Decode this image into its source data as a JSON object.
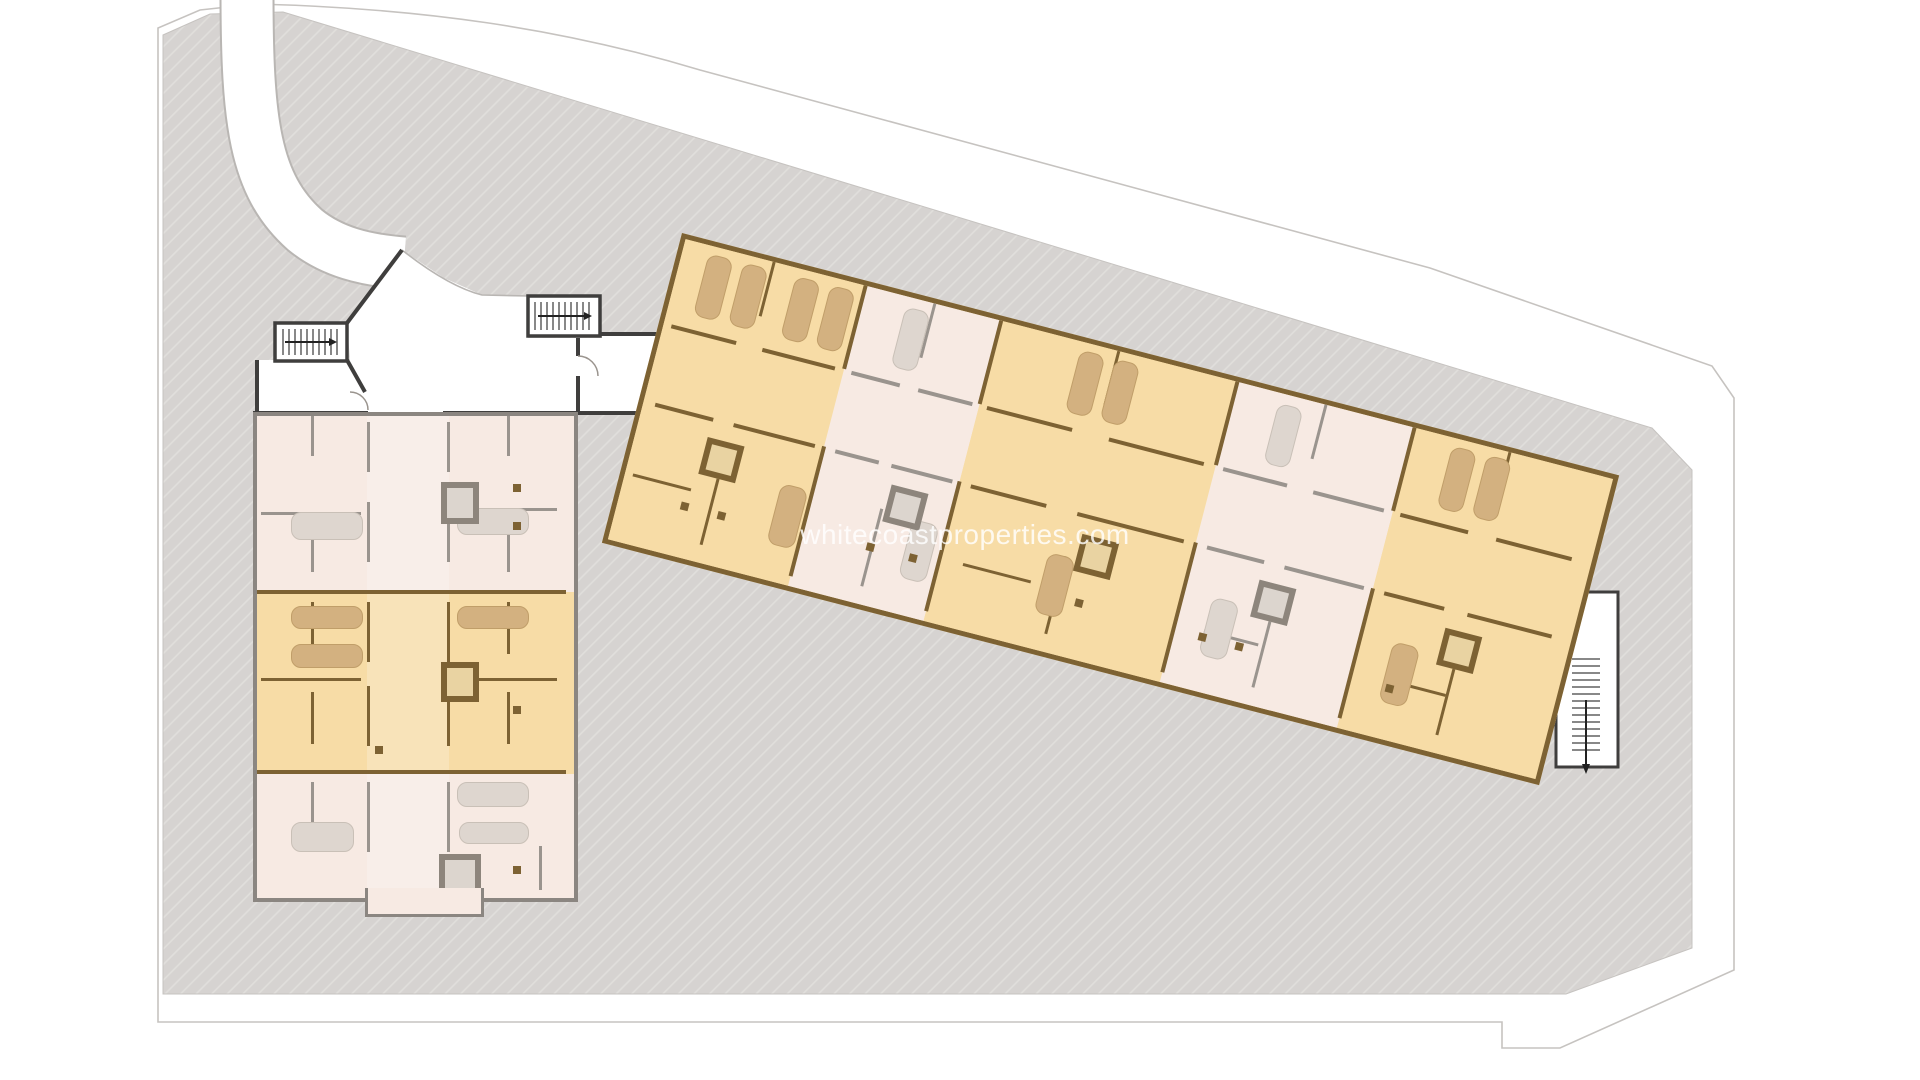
{
  "watermark": {
    "text": "whitecoastproperties.com"
  },
  "colors": {
    "page_bg": "#ffffff",
    "plot_fill": "#d6d3d1",
    "hatch_line": "#e1dfdc",
    "boundary_line": "#c6c3c0",
    "road_edge": "#b9b6b3",
    "black_wall": "#3f3e3d",
    "orange_fill": "#f7dca6",
    "orange_wall": "#7d6233",
    "orange_core_fill": "#e9d3a2",
    "tan_bed": "#d3b180",
    "tan_bed_border": "#c09e69",
    "pink_fill": "#f7eae3",
    "pink_wall": "#9a948e",
    "pink_bed": "#ded6cf",
    "pink_bed_border": "#c9c0b7",
    "pink_core_fill": "#dcd5ce",
    "gray_core_wall": "#8d857c",
    "left_wall": "#8b8681",
    "stair_tread": "#555555"
  },
  "angled_building": {
    "units": [
      {
        "x": 0,
        "w": 186,
        "color": "orange_fill",
        "wall": "orange_wall"
      },
      {
        "x": 186,
        "w": 140,
        "color": "pink_fill",
        "wall": "pink_wall"
      },
      {
        "x": 326,
        "w": 244,
        "color": "orange_fill",
        "wall": "orange_wall"
      },
      {
        "x": 570,
        "w": 183,
        "color": "pink_fill",
        "wall": "pink_wall"
      },
      {
        "x": 753,
        "w": 195,
        "color": "orange_fill",
        "wall": "orange_wall"
      }
    ],
    "walls": [
      {
        "x": 184,
        "y": 0,
        "w": 4,
        "h": 86,
        "c": "orange_wall"
      },
      {
        "x": 184,
        "y": 166,
        "w": 4,
        "h": 134,
        "c": "orange_wall"
      },
      {
        "x": 324,
        "y": 0,
        "w": 4,
        "h": 86,
        "c": "orange_wall"
      },
      {
        "x": 324,
        "y": 166,
        "w": 4,
        "h": 134,
        "c": "orange_wall"
      },
      {
        "x": 568,
        "y": 0,
        "w": 4,
        "h": 86,
        "c": "orange_wall"
      },
      {
        "x": 568,
        "y": 166,
        "w": 4,
        "h": 134,
        "c": "orange_wall"
      },
      {
        "x": 751,
        "y": 0,
        "w": 4,
        "h": 86,
        "c": "orange_wall"
      },
      {
        "x": 751,
        "y": 166,
        "w": 4,
        "h": 134,
        "c": "orange_wall"
      },
      {
        "x": 90,
        "y": 0,
        "w": 3,
        "h": 56,
        "c": "orange_wall"
      },
      {
        "x": 256,
        "y": 0,
        "w": 3,
        "h": 56,
        "c": "pink_wall"
      },
      {
        "x": 446,
        "y": 0,
        "w": 3,
        "h": 56,
        "c": "orange_wall"
      },
      {
        "x": 660,
        "y": 0,
        "w": 3,
        "h": 56,
        "c": "pink_wall"
      },
      {
        "x": 850,
        "y": 0,
        "w": 3,
        "h": 56,
        "c": "orange_wall"
      },
      {
        "x": 90,
        "y": 212,
        "w": 3,
        "h": 80,
        "c": "orange_wall"
      },
      {
        "x": 256,
        "y": 212,
        "w": 3,
        "h": 80,
        "c": "pink_wall"
      },
      {
        "x": 446,
        "y": 212,
        "w": 3,
        "h": 80,
        "c": "orange_wall"
      },
      {
        "x": 660,
        "y": 212,
        "w": 3,
        "h": 80,
        "c": "pink_wall"
      },
      {
        "x": 850,
        "y": 212,
        "w": 3,
        "h": 80,
        "c": "orange_wall"
      },
      {
        "x": 8,
        "y": 240,
        "w": 60,
        "h": 3,
        "c": "orange_wall"
      },
      {
        "x": 350,
        "y": 244,
        "w": 70,
        "h": 3,
        "c": "orange_wall"
      },
      {
        "x": 600,
        "y": 248,
        "w": 56,
        "h": 3,
        "c": "pink_wall"
      },
      {
        "x": 790,
        "y": 250,
        "w": 60,
        "h": 3,
        "c": "orange_wall"
      }
    ],
    "beds": [
      {
        "x": 26,
        "y": 8,
        "w": 26,
        "h": 64,
        "t": "tan"
      },
      {
        "x": 62,
        "y": 8,
        "w": 26,
        "h": 64,
        "t": "tan"
      },
      {
        "x": 116,
        "y": 8,
        "w": 26,
        "h": 64,
        "t": "tan"
      },
      {
        "x": 152,
        "y": 8,
        "w": 26,
        "h": 64,
        "t": "tan"
      },
      {
        "x": 230,
        "y": 10,
        "w": 26,
        "h": 62,
        "t": "pink"
      },
      {
        "x": 410,
        "y": 8,
        "w": 26,
        "h": 64,
        "t": "tan"
      },
      {
        "x": 446,
        "y": 8,
        "w": 26,
        "h": 64,
        "t": "tan"
      },
      {
        "x": 615,
        "y": 10,
        "w": 26,
        "h": 62,
        "t": "pink"
      },
      {
        "x": 794,
        "y": 8,
        "w": 26,
        "h": 64,
        "t": "tan"
      },
      {
        "x": 830,
        "y": 8,
        "w": 26,
        "h": 64,
        "t": "tan"
      },
      {
        "x": 154,
        "y": 212,
        "w": 28,
        "h": 62,
        "t": "tan"
      },
      {
        "x": 290,
        "y": 214,
        "w": 28,
        "h": 60,
        "t": "pink"
      },
      {
        "x": 430,
        "y": 212,
        "w": 28,
        "h": 62,
        "t": "tan"
      },
      {
        "x": 600,
        "y": 214,
        "w": 28,
        "h": 60,
        "t": "pink"
      },
      {
        "x": 786,
        "y": 212,
        "w": 28,
        "h": 62,
        "t": "tan"
      }
    ],
    "cores": [
      {
        "x": 71,
        "y": 186,
        "w": 38,
        "h": 38,
        "wall": "orange_wall",
        "fill": "orange_core_fill"
      },
      {
        "x": 261,
        "y": 186,
        "w": 38,
        "h": 38,
        "wall": "gray_core_wall",
        "fill": "pink_core_fill"
      },
      {
        "x": 458,
        "y": 186,
        "w": 38,
        "h": 38,
        "wall": "orange_wall",
        "fill": "orange_core_fill"
      },
      {
        "x": 641,
        "y": 186,
        "w": 38,
        "h": 38,
        "wall": "gray_core_wall",
        "fill": "pink_core_fill"
      },
      {
        "x": 833,
        "y": 186,
        "w": 38,
        "h": 38,
        "wall": "orange_wall",
        "fill": "orange_core_fill"
      }
    ],
    "columns": [
      {
        "x": 62,
        "y": 255
      },
      {
        "x": 100,
        "y": 255
      },
      {
        "x": 252,
        "y": 248
      },
      {
        "x": 296,
        "y": 248
      },
      {
        "x": 468,
        "y": 250
      },
      {
        "x": 596,
        "y": 252
      },
      {
        "x": 634,
        "y": 252
      },
      {
        "x": 790,
        "y": 255
      }
    ]
  },
  "left_building": {
    "bands": [
      {
        "y": 0,
        "h": 176,
        "color": "pink_fill"
      },
      {
        "y": 176,
        "h": 182,
        "color": "orange_fill"
      },
      {
        "y": 358,
        "h": 116,
        "color": "pink_fill"
      }
    ],
    "corridor": {
      "x": 110,
      "w": 82
    },
    "walls": [
      {
        "x": 0,
        "y": 174,
        "w": 309,
        "h": 4,
        "c": "orange_wall"
      },
      {
        "x": 0,
        "y": 354,
        "w": 309,
        "h": 4,
        "c": "orange_wall"
      },
      {
        "x": 110,
        "y": 6,
        "w": 3,
        "h": 50,
        "c": "pink_wall"
      },
      {
        "x": 110,
        "y": 86,
        "w": 3,
        "h": 60,
        "c": "pink_wall"
      },
      {
        "x": 110,
        "y": 186,
        "w": 3,
        "h": 60,
        "c": "orange_wall"
      },
      {
        "x": 110,
        "y": 270,
        "w": 3,
        "h": 60,
        "c": "orange_wall"
      },
      {
        "x": 110,
        "y": 366,
        "w": 3,
        "h": 70,
        "c": "pink_wall"
      },
      {
        "x": 190,
        "y": 6,
        "w": 3,
        "h": 50,
        "c": "pink_wall"
      },
      {
        "x": 190,
        "y": 86,
        "w": 3,
        "h": 60,
        "c": "pink_wall"
      },
      {
        "x": 190,
        "y": 186,
        "w": 3,
        "h": 60,
        "c": "orange_wall"
      },
      {
        "x": 190,
        "y": 270,
        "w": 3,
        "h": 60,
        "c": "orange_wall"
      },
      {
        "x": 190,
        "y": 366,
        "w": 3,
        "h": 70,
        "c": "pink_wall"
      },
      {
        "x": 54,
        "y": 0,
        "w": 3,
        "h": 40,
        "c": "pink_wall"
      },
      {
        "x": 54,
        "y": 100,
        "w": 3,
        "h": 56,
        "c": "pink_wall"
      },
      {
        "x": 250,
        "y": 0,
        "w": 3,
        "h": 40,
        "c": "pink_wall"
      },
      {
        "x": 250,
        "y": 100,
        "w": 3,
        "h": 56,
        "c": "pink_wall"
      },
      {
        "x": 54,
        "y": 186,
        "w": 3,
        "h": 52,
        "c": "orange_wall"
      },
      {
        "x": 250,
        "y": 186,
        "w": 3,
        "h": 52,
        "c": "orange_wall"
      },
      {
        "x": 54,
        "y": 276,
        "w": 3,
        "h": 52,
        "c": "orange_wall"
      },
      {
        "x": 250,
        "y": 276,
        "w": 3,
        "h": 52,
        "c": "orange_wall"
      },
      {
        "x": 54,
        "y": 366,
        "w": 3,
        "h": 44,
        "c": "pink_wall"
      },
      {
        "x": 282,
        "y": 430,
        "w": 3,
        "h": 44,
        "c": "pink_wall"
      },
      {
        "x": 4,
        "y": 96,
        "w": 100,
        "h": 3,
        "c": "pink_wall"
      },
      {
        "x": 200,
        "y": 92,
        "w": 100,
        "h": 3,
        "c": "pink_wall"
      },
      {
        "x": 4,
        "y": 262,
        "w": 100,
        "h": 3,
        "c": "orange_wall"
      },
      {
        "x": 200,
        "y": 262,
        "w": 100,
        "h": 3,
        "c": "orange_wall"
      }
    ],
    "beds": [
      {
        "x": 34,
        "y": 96,
        "w": 72,
        "h": 28,
        "t": "pink"
      },
      {
        "x": 200,
        "y": 92,
        "w": 72,
        "h": 27,
        "t": "pink"
      },
      {
        "x": 34,
        "y": 190,
        "w": 72,
        "h": 23,
        "t": "tan"
      },
      {
        "x": 34,
        "y": 228,
        "w": 72,
        "h": 24,
        "t": "tan"
      },
      {
        "x": 200,
        "y": 190,
        "w": 72,
        "h": 23,
        "t": "tan"
      },
      {
        "x": 34,
        "y": 406,
        "w": 63,
        "h": 30,
        "t": "pink"
      },
      {
        "x": 200,
        "y": 366,
        "w": 72,
        "h": 25,
        "t": "pink"
      },
      {
        "x": 202,
        "y": 406,
        "w": 70,
        "h": 22,
        "t": "pink"
      }
    ],
    "cores": [
      {
        "x": 184,
        "y": 66,
        "w": 38,
        "h": 42,
        "wall": "gray_core_wall",
        "fill": "pink_core_fill"
      },
      {
        "x": 184,
        "y": 246,
        "w": 38,
        "h": 40,
        "wall": "orange_wall",
        "fill": "orange_core_fill"
      },
      {
        "x": 182,
        "y": 438,
        "w": 42,
        "h": 52,
        "wall": "gray_core_wall",
        "fill": "pink_core_fill"
      }
    ],
    "columns": [
      {
        "x": 256,
        "y": 68
      },
      {
        "x": 256,
        "y": 106
      },
      {
        "x": 256,
        "y": 290
      },
      {
        "x": 118,
        "y": 330
      },
      {
        "x": 256,
        "y": 450
      }
    ]
  }
}
